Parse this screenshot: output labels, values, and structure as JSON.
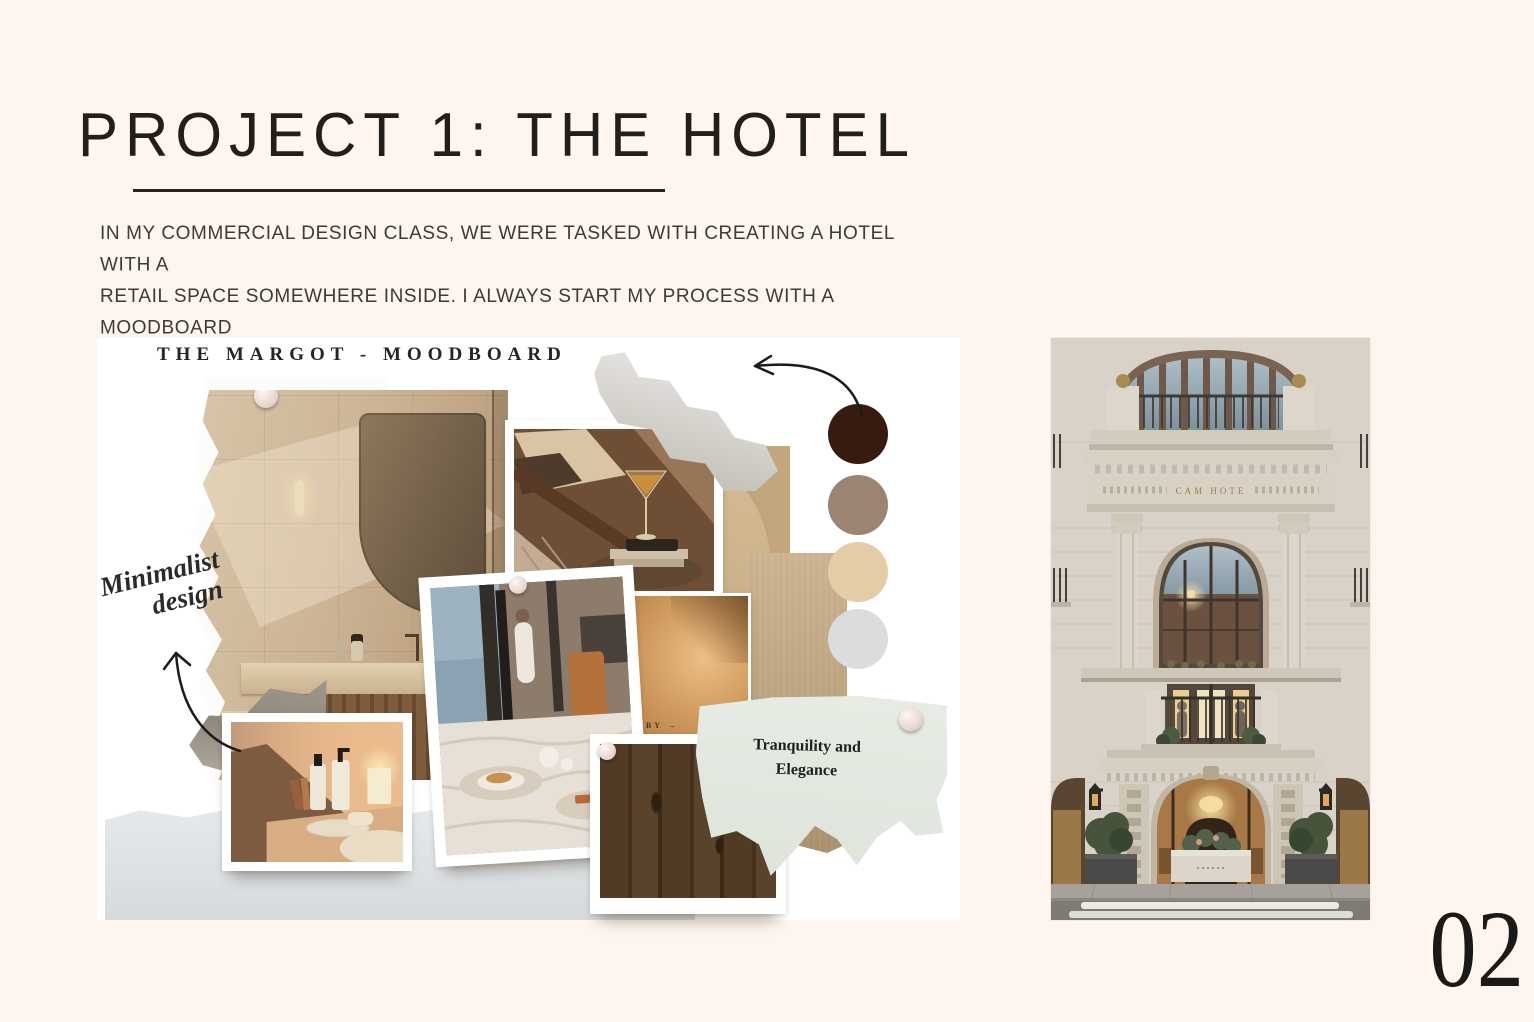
{
  "page": {
    "background_color": "#fdf5ee",
    "page_number": "02"
  },
  "header": {
    "title": "PROJECT 1: THE HOTEL",
    "description_lines": [
      "IN MY COMMERCIAL DESIGN CLASS, WE WERE TASKED WITH CREATING A HOTEL WITH A",
      "RETAIL SPACE SOMEWHERE INSIDE. I ALWAYS START MY PROCESS WITH A MOODBOARD",
      "AND INSPIRATION PHOTOS."
    ]
  },
  "moodboard": {
    "title": "THE MARGOT - MOODBOARD",
    "annotation": {
      "line1": "Minimalist",
      "line2": "design"
    },
    "lobby_label": "LOBBY →",
    "note": {
      "line1": "Tranquility and",
      "line2": "Elegance"
    },
    "palette": [
      {
        "name": "espresso-brown",
        "hex": "#371b10"
      },
      {
        "name": "taupe",
        "hex": "#9b8471"
      },
      {
        "name": "sand-beige",
        "hex": "#e4cca7"
      },
      {
        "name": "light-gray",
        "hex": "#dcdcde"
      }
    ]
  },
  "facade_photo": {
    "sign_text": "CAM HOTE"
  },
  "icons": {
    "push_pin": "round-pin-circle",
    "annotation_arrow": "hand-drawn-curved-arrow",
    "palette_arrow": "hand-drawn-curved-arrow"
  },
  "colors": {
    "ink": "#211e1b",
    "moodboard_canvas": "#ffffff",
    "sage_paper": "#e2e8df",
    "wood_swatch": "#4a3520"
  }
}
